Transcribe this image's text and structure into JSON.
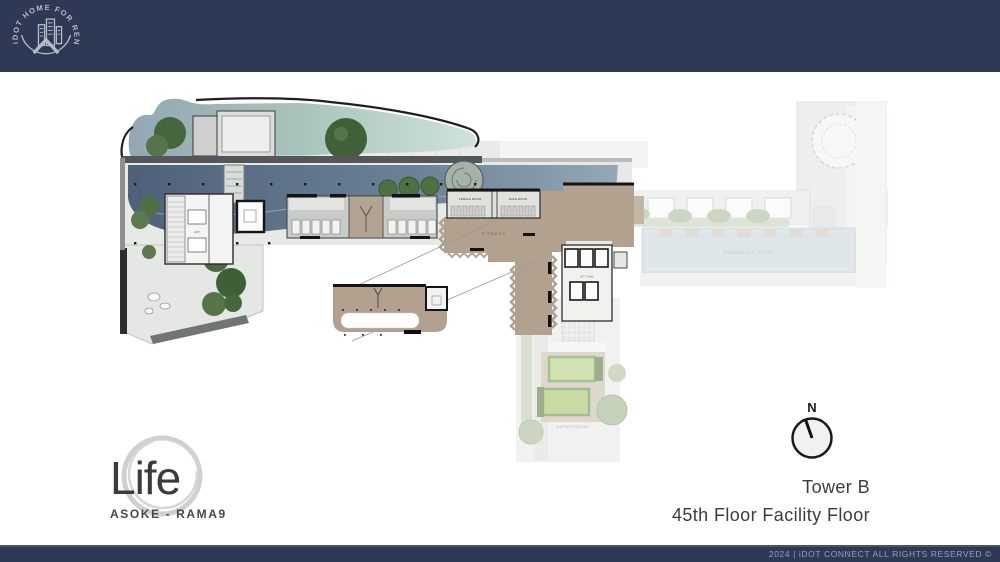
{
  "header": {
    "logo_ring_text": "iDOT HOME FOR RENT"
  },
  "branding": {
    "name": "Life",
    "subtitle": "ASOKE - RAMA9"
  },
  "info": {
    "tower": "Tower B",
    "floor": "45th Floor Facility Floor",
    "compass_n": "N"
  },
  "footer": {
    "text": "2024 | iDOT CONNECT  ALL RIGHTS RESERVED  ©"
  },
  "plan_labels": {
    "female_room": "FEMALE ROOM",
    "male_room": "MALE ROOM",
    "fitness": "FITNESS",
    "lift": "LIFT",
    "lift_hall": "LIFT HALL",
    "swimming_pool": "SWIMMING POOL",
    "amphitheater": "AMPHITHEATER"
  },
  "colors": {
    "navy": "#2e3a55",
    "silver": "#b4bac6",
    "tan": "#b1a18e",
    "pond_dark": "#4f617a",
    "pool_teal": "#b3d0c2",
    "pool_light": "#c5d2d8",
    "tree_green": "#4a6940",
    "text_dark": "#3c3c3c"
  }
}
